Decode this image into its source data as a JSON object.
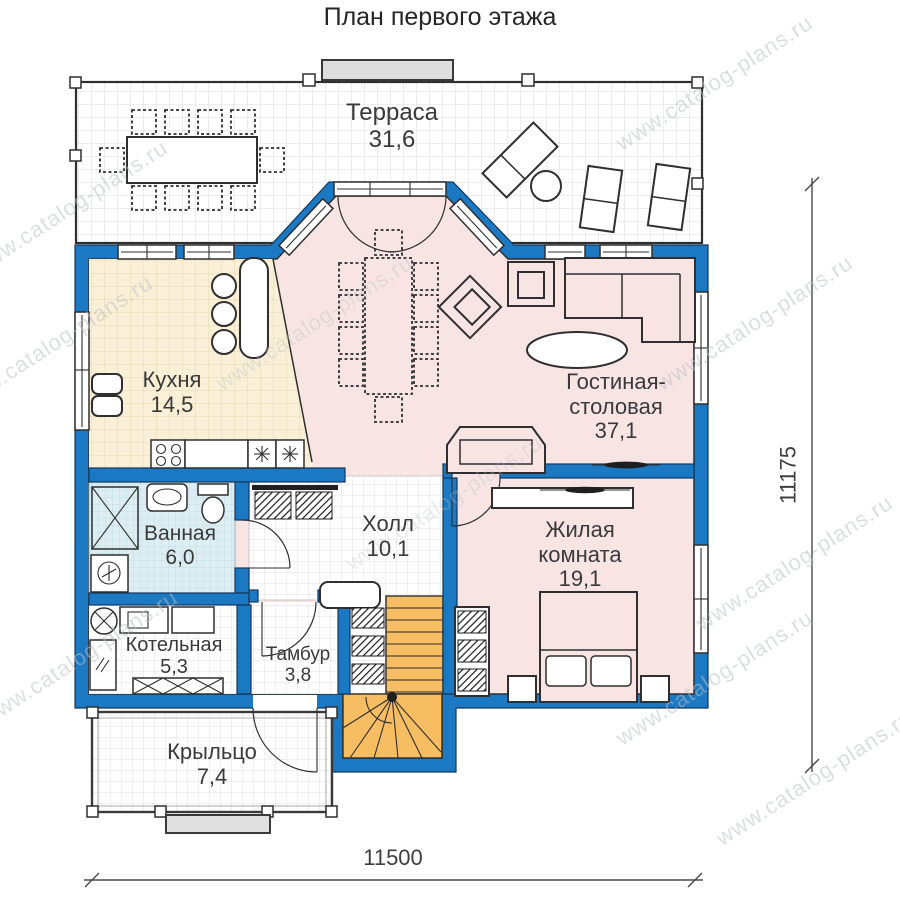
{
  "title": "План первого этажа",
  "watermark": "www.catalog-plans.ru",
  "rooms": {
    "terrace": {
      "name": "Терраса",
      "area": "31,6"
    },
    "kitchen": {
      "name": "Кухня",
      "area": "14,5"
    },
    "living_dining": {
      "name_line1": "Гостиная-",
      "name_line2": "столовая",
      "area": "37,1"
    },
    "bathroom": {
      "name": "Ванная",
      "area": "6,0"
    },
    "hall": {
      "name": "Холл",
      "area": "10,1"
    },
    "living_room": {
      "name_line1": "Жилая",
      "name_line2": "комната",
      "area": "19,1"
    },
    "boiler": {
      "name": "Котельная",
      "area": "5,3"
    },
    "tambour": {
      "name": "Тамбур",
      "area": "3,8"
    },
    "porch": {
      "name": "Крыльцо",
      "area": "7,4"
    }
  },
  "dimensions": {
    "width": "11500",
    "height": "11175"
  },
  "colors": {
    "wall": "#1b79c4",
    "wall_outline": "#14375c",
    "floor_main": "#f8e4e3",
    "floor_kitchen": "#faf0d8",
    "floor_bathroom": "#ddeef3",
    "stairs": "#f6bd62",
    "steps": "#e0e0e0"
  }
}
